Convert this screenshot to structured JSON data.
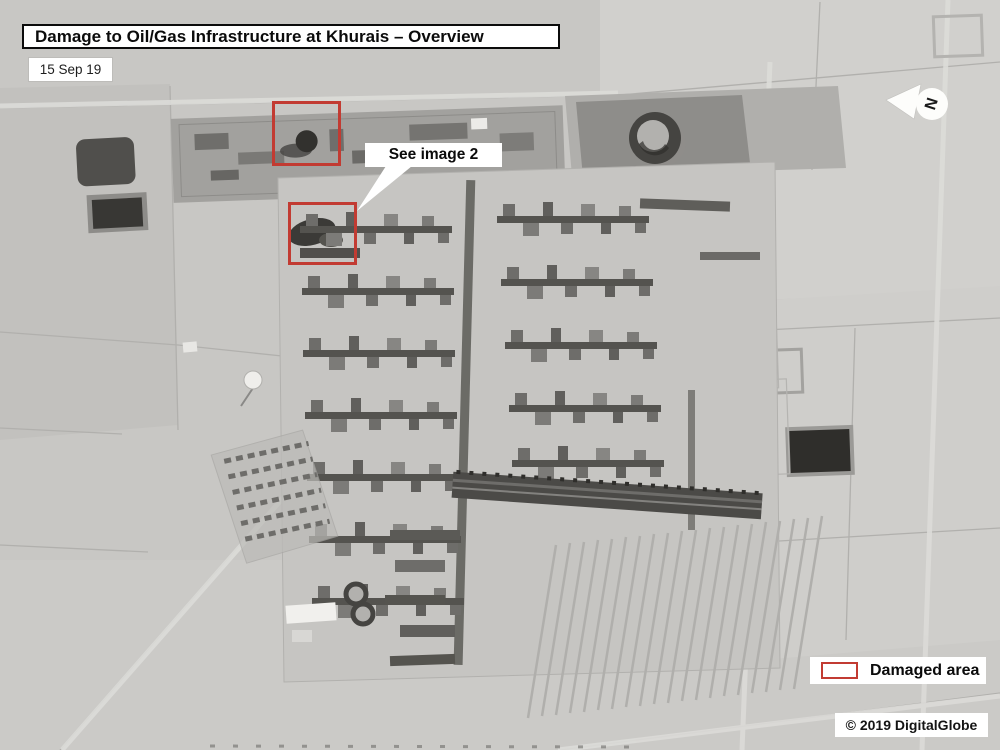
{
  "header": {
    "title": "Damage to Oil/Gas Infrastructure at Khurais – Overview",
    "date": "15 Sep 19"
  },
  "map": {
    "callout_label": "See image 2",
    "compass_label": "N"
  },
  "legend": {
    "swatch_label": "Damaged area"
  },
  "footer": {
    "credit": "© 2019 DigitalGlobe"
  },
  "colors": {
    "damage_red": "#c23b32",
    "annotation_bg": "#ffffff",
    "annotation_text": "#0b0b0b"
  }
}
